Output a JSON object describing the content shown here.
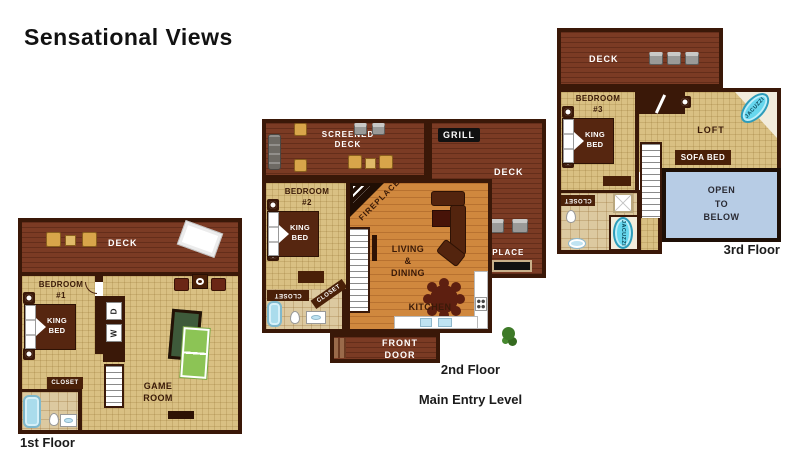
{
  "title": "Sensational Views",
  "colors": {
    "deck": "#7b3b24",
    "wall": "#3a1808",
    "interior": "#d9c083",
    "wood": "#d0883e",
    "tile": "#dcc9a0",
    "open_below": "#b7cce5",
    "jacuzzi": "#67d7ee",
    "pool": "#3e5a3a",
    "pingpong": "#8cc455",
    "bed": "#562610",
    "label": "#3a1a08"
  },
  "floor1": {
    "name": "1st Floor",
    "deck_label": "DECK",
    "bedroom_label": "BEDROOM\n#1",
    "king_bed_label": "KING\nBED",
    "closet_label": "CLOSET",
    "game_room_label": "GAME\nROOM",
    "dryer_label": "D",
    "washer_label": "W"
  },
  "floor2": {
    "name_line1": "2nd Floor",
    "name_line2": "Main Entry Level",
    "screened_deck_label": "SCREENED\nDECK",
    "grill_label": "GRILL",
    "deck_label": "DECK",
    "deck_fireplace_label": "FIREPLACE",
    "bedroom_label": "BEDROOM\n#2",
    "king_bed_label": "KING\nBED",
    "corner_fireplace_label": "FIREPLACE",
    "living_dining_label": "LIVING\n&\nDINING",
    "kitchen_label": "KITCHEN",
    "front_door_label": "FRONT\nDOOR",
    "closet1_label": "CLOSET",
    "closet2_label": "CLOSET"
  },
  "floor3": {
    "name": "3rd Floor",
    "deck_label": "DECK",
    "bedroom_label": "BEDROOM\n#3",
    "king_bed_label": "KING\nBED",
    "loft_label": "LOFT",
    "loft_jacuzzi_label": "JACUZZI",
    "sofa_bed_label": "SOFA BED",
    "open_below_label": "OPEN\nTO\nBELOW",
    "closet_label": "CLOSET",
    "bath_jacuzzi_label": "JACUZZI"
  }
}
